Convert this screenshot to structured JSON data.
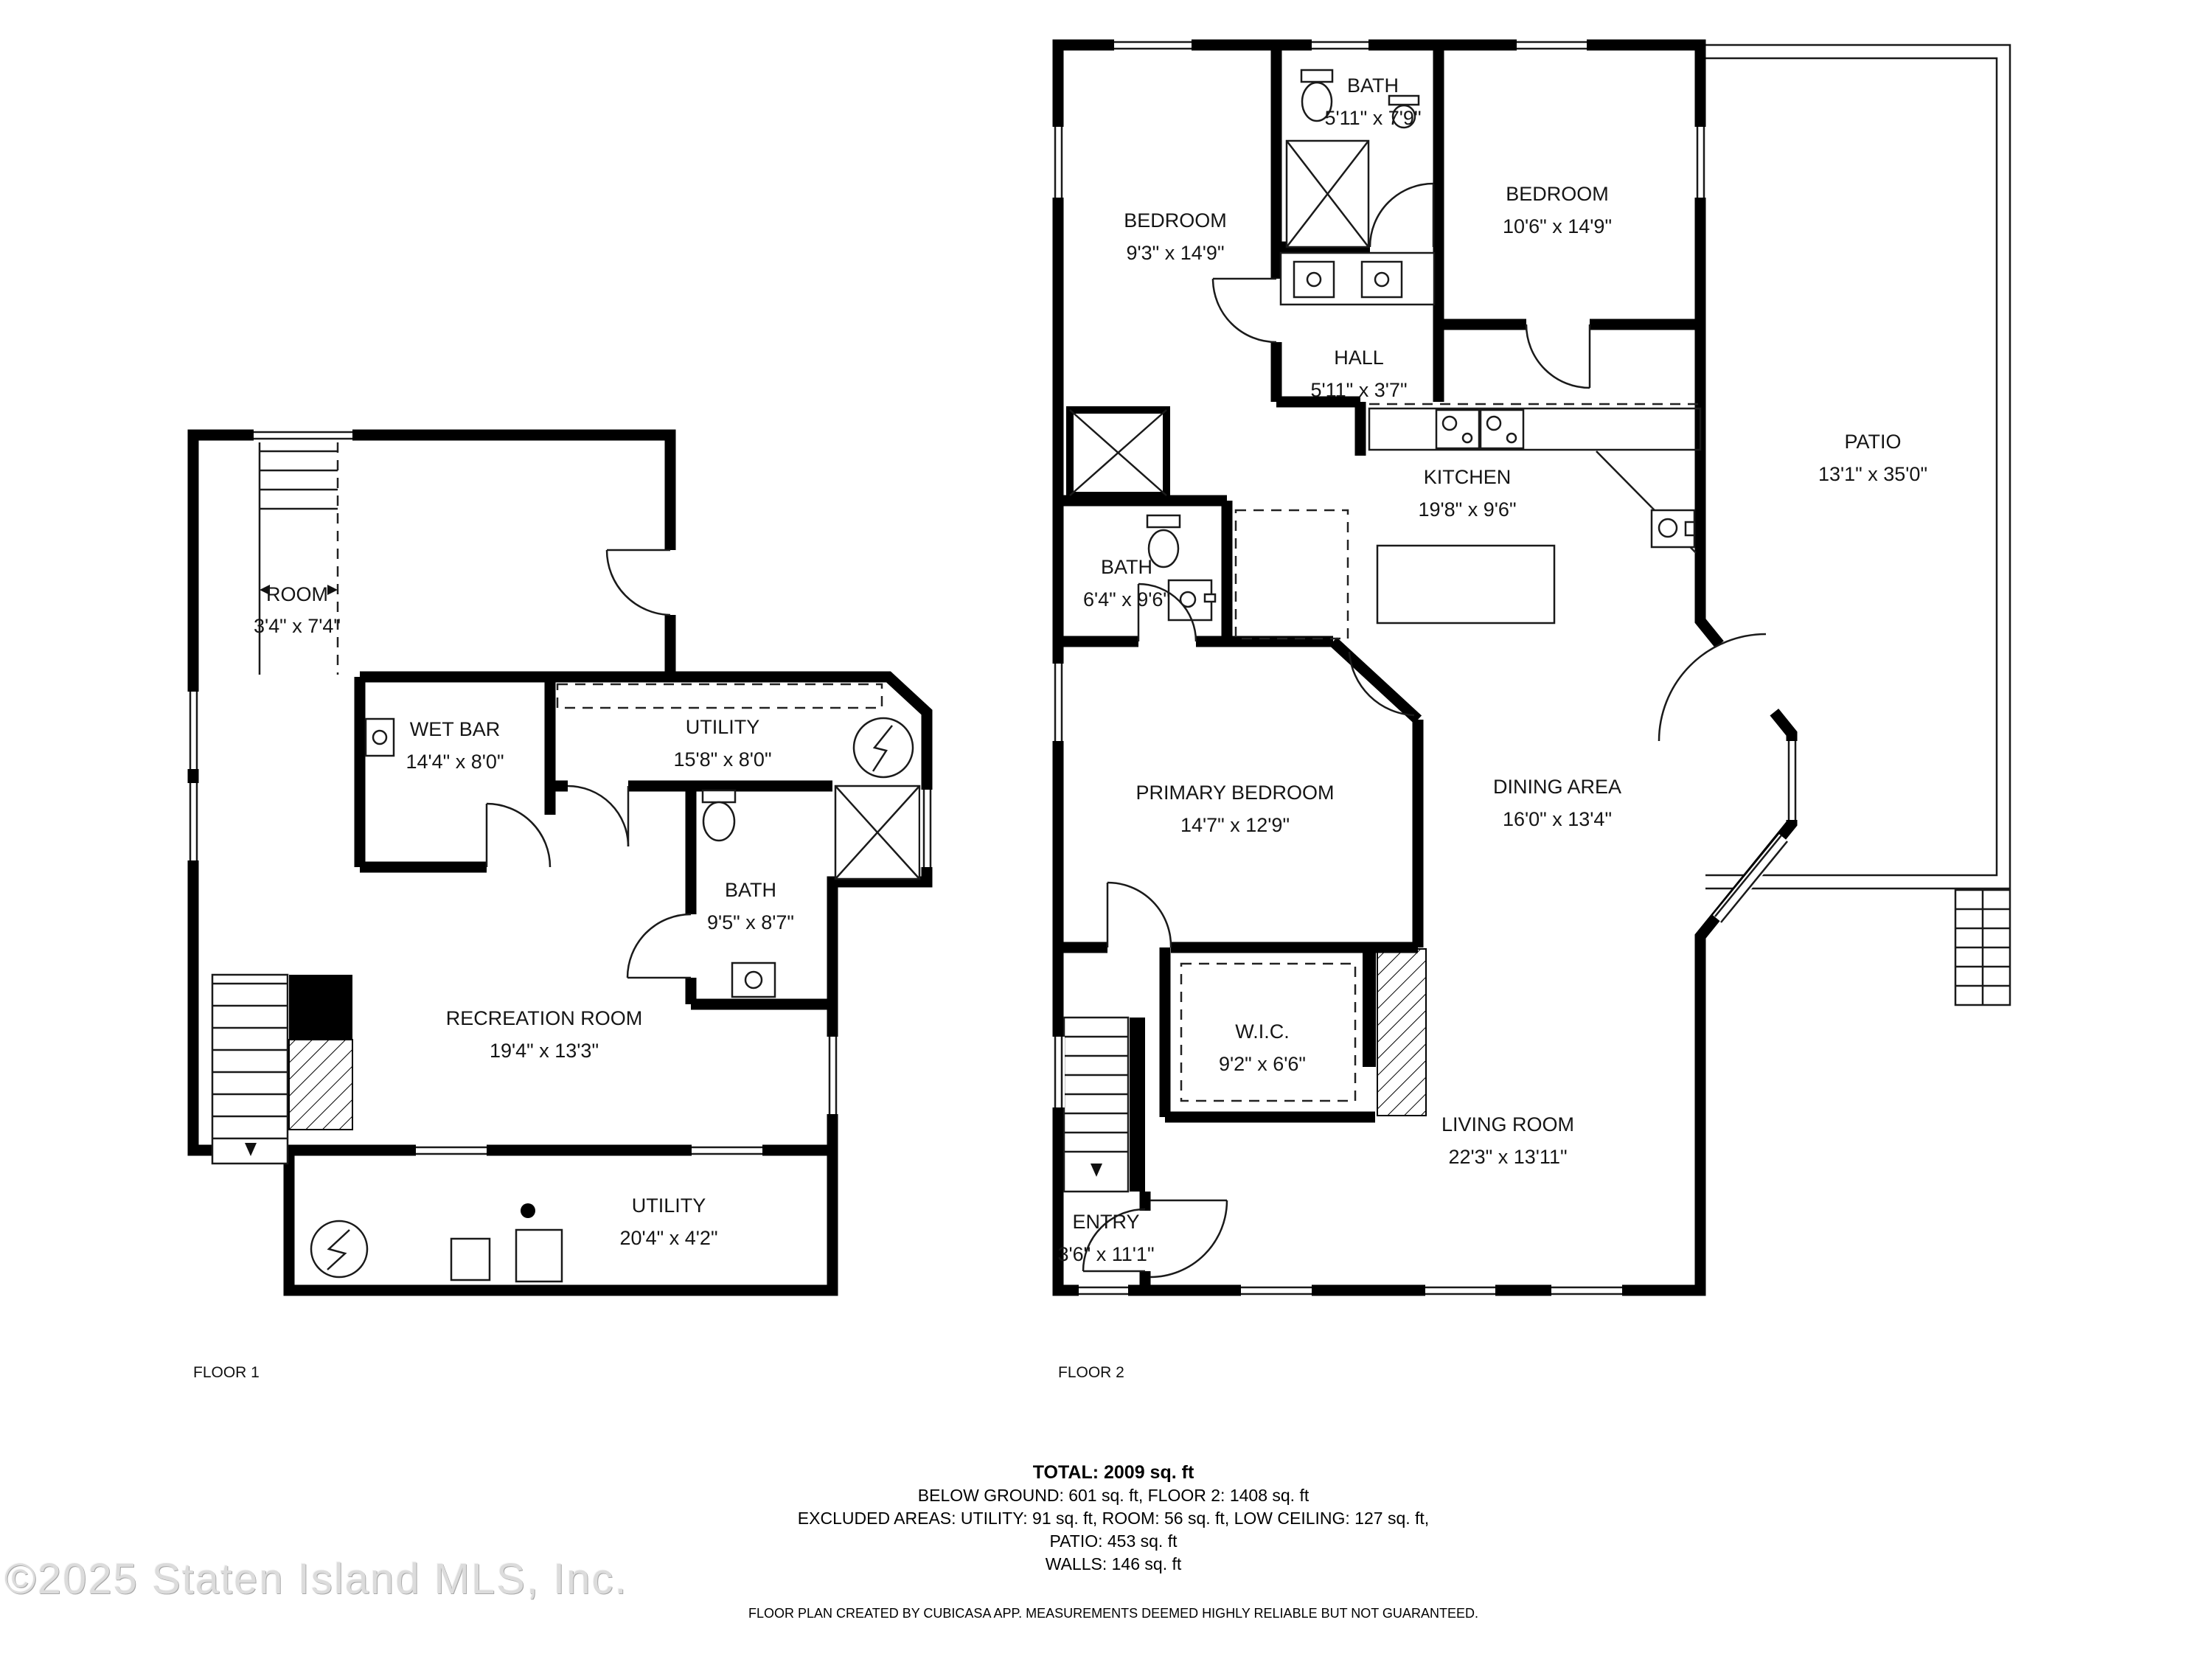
{
  "colors": {
    "wall": "#000000",
    "background": "#ffffff",
    "watermark_gray": "#dcdcdc"
  },
  "floor1": {
    "label": "FLOOR 1",
    "rooms": {
      "room": {
        "name": "ROOM",
        "dims": "3'4\" x 7'4\""
      },
      "wet_bar": {
        "name": "WET BAR",
        "dims": "14'4\" x 8'0\""
      },
      "utility_upper": {
        "name": "UTILITY",
        "dims": "15'8\" x 8'0\""
      },
      "bath": {
        "name": "BATH",
        "dims": "9'5\" x 8'7\""
      },
      "recreation": {
        "name": "RECREATION ROOM",
        "dims": "19'4\" x 13'3\""
      },
      "utility_lower": {
        "name": "UTILITY",
        "dims": "20'4\" x 4'2\""
      }
    }
  },
  "floor2": {
    "label": "FLOOR 2",
    "rooms": {
      "bath_upper": {
        "name": "BATH",
        "dims": "5'11\" x 7'9\""
      },
      "bedroom_left": {
        "name": "BEDROOM",
        "dims": "9'3\" x 14'9\""
      },
      "bedroom_right": {
        "name": "BEDROOM",
        "dims": "10'6\" x 14'9\""
      },
      "hall": {
        "name": "HALL",
        "dims": "5'11\" x 3'7\""
      },
      "kitchen": {
        "name": "KITCHEN",
        "dims": "19'8\" x 9'6\""
      },
      "patio": {
        "name": "PATIO",
        "dims": "13'1\" x 35'0\""
      },
      "bath_mid": {
        "name": "BATH",
        "dims": "6'4\" x 9'6\""
      },
      "primary_bedroom": {
        "name": "PRIMARY BEDROOM",
        "dims": "14'7\" x 12'9\""
      },
      "dining": {
        "name": "DINING AREA",
        "dims": "16'0\" x 13'4\""
      },
      "wic": {
        "name": "W.I.C.",
        "dims": "9'2\" x 6'6\""
      },
      "living": {
        "name": "LIVING ROOM",
        "dims": "22'3\" x 13'11\""
      },
      "entry": {
        "name": "ENTRY",
        "dims": "3'6\" x 11'1\""
      }
    }
  },
  "summary": {
    "total": "TOTAL: 2009 sq. ft",
    "line1": "BELOW GROUND: 601 sq. ft, FLOOR 2: 1408 sq. ft",
    "line2": "EXCLUDED AREAS: UTILITY: 91 sq. ft, ROOM: 56 sq. ft, LOW CEILING: 127 sq. ft,",
    "line3": "PATIO: 453 sq. ft",
    "line4": "WALLS: 146 sq. ft"
  },
  "footer": {
    "disclaimer": "FLOOR PLAN CREATED BY CUBICASA APP. MEASUREMENTS DEEMED HIGHLY RELIABLE BUT NOT GUARANTEED."
  },
  "watermark": "©2025 Staten Island MLS, Inc."
}
